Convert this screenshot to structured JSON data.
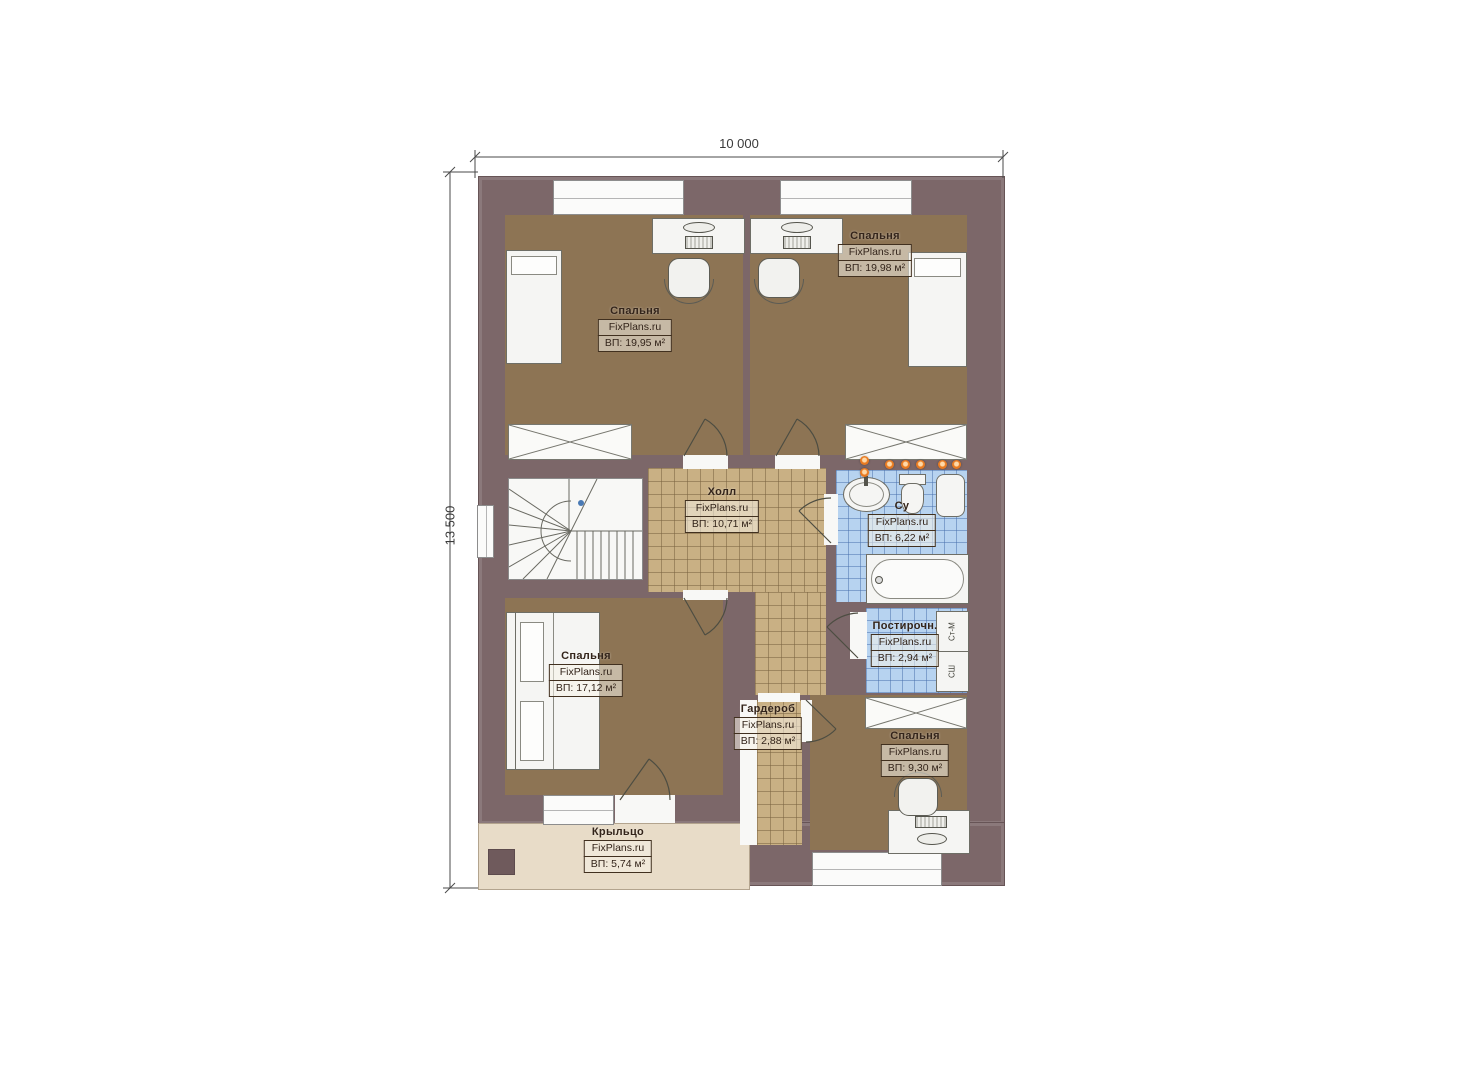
{
  "dimensions": {
    "width": "10 000",
    "height": "13 500"
  },
  "watermark": "FixPlans.ru",
  "rooms": {
    "bedroom_top_left": {
      "name": "Спальня",
      "area": "ВП: 19,95 м²"
    },
    "bedroom_top_right": {
      "name": "Спальня",
      "area": "ВП: 19,98 м²"
    },
    "hall": {
      "name": "Холл",
      "area": "ВП: 10,71 м²"
    },
    "bathroom": {
      "name": "Су",
      "area": "ВП: 6,22 м²"
    },
    "laundry": {
      "name": "Постирочн.",
      "area": "ВП: 2,94 м²"
    },
    "bedroom_bottom_left": {
      "name": "Спальня",
      "area": "ВП: 17,12 м²"
    },
    "wardrobe": {
      "name": "Гардероб",
      "area": "ВП: 2,88 м²"
    },
    "bedroom_bottom_right": {
      "name": "Спальня",
      "area": "ВП: 9,30 м²"
    },
    "porch": {
      "name": "Крыльцо",
      "area": "ВП: 5,74 м²"
    }
  },
  "appliances": {
    "washing_machine": "Ст-М",
    "dryer": "СШ"
  },
  "colors": {
    "wall": "#7c6769",
    "bedroom_floor": "#8d7454",
    "hall_tile": "#c9b084",
    "wet_room_tile": "#b7d3f0",
    "porch": "#e8dcc8",
    "accent_orange": "#e87a20",
    "stair_marker_blue": "#4a7ab5"
  }
}
